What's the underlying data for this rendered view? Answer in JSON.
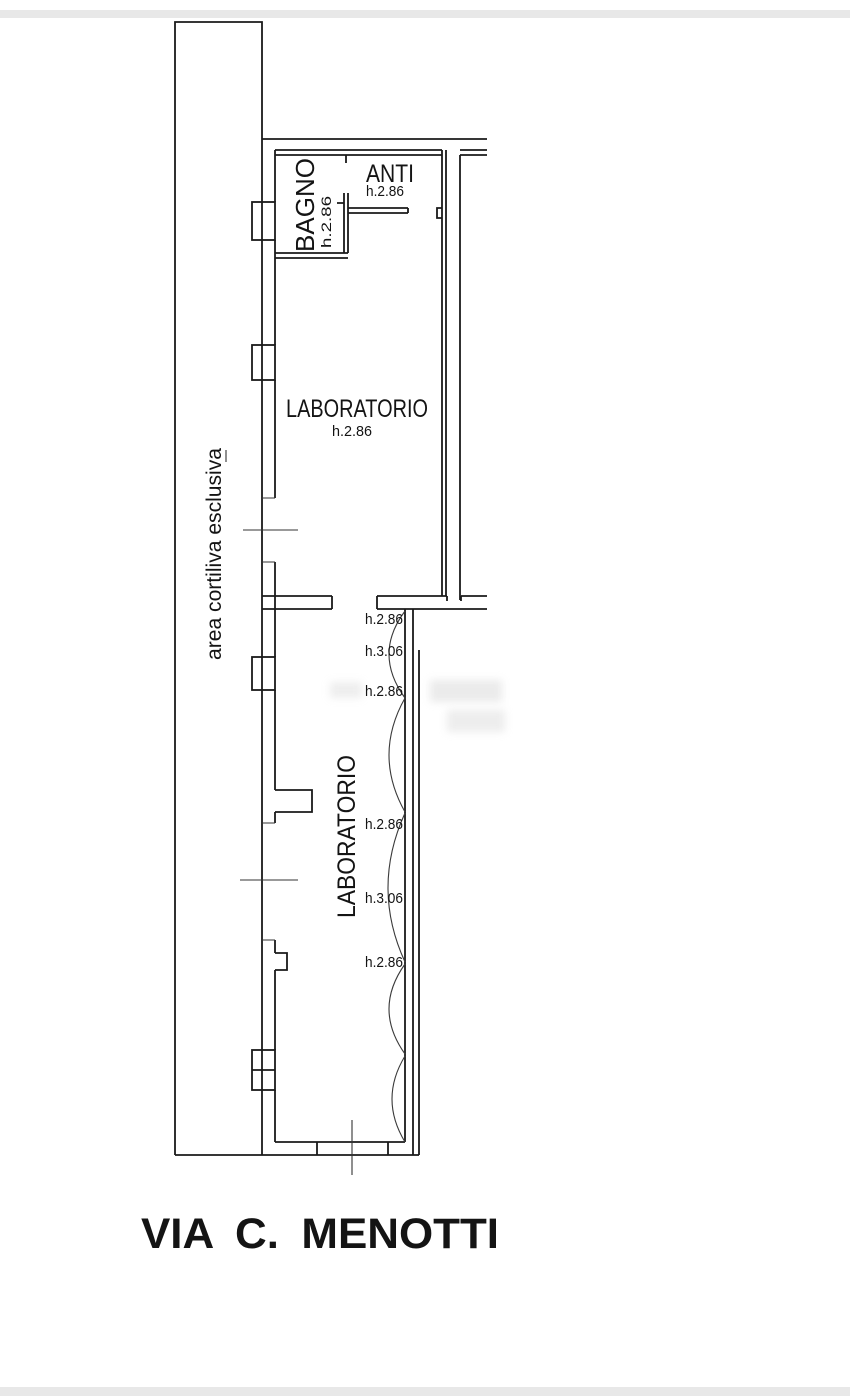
{
  "drawing": {
    "street_label": "VIA  C.  MENOTTI",
    "street_color": "#1e86e8",
    "courtyard_label": "area cortiliva esclusiva",
    "bagno": {
      "name": "BAGNO",
      "height": "h.2.86"
    },
    "anti": {
      "name": "ANTI",
      "height": "h.2.86"
    },
    "laboratorio_upper": {
      "name": "LABORATORIO",
      "height": "h.2.86"
    },
    "laboratorio_lower": {
      "name": "LABORATORIO"
    },
    "vault_heights_upper": [
      "h.2.86",
      "h.3.06",
      "h.2.86"
    ],
    "vault_heights_lower": [
      "h.2.86",
      "h.3.06",
      "h.2.86"
    ],
    "line_color": "#1a1a1a"
  }
}
